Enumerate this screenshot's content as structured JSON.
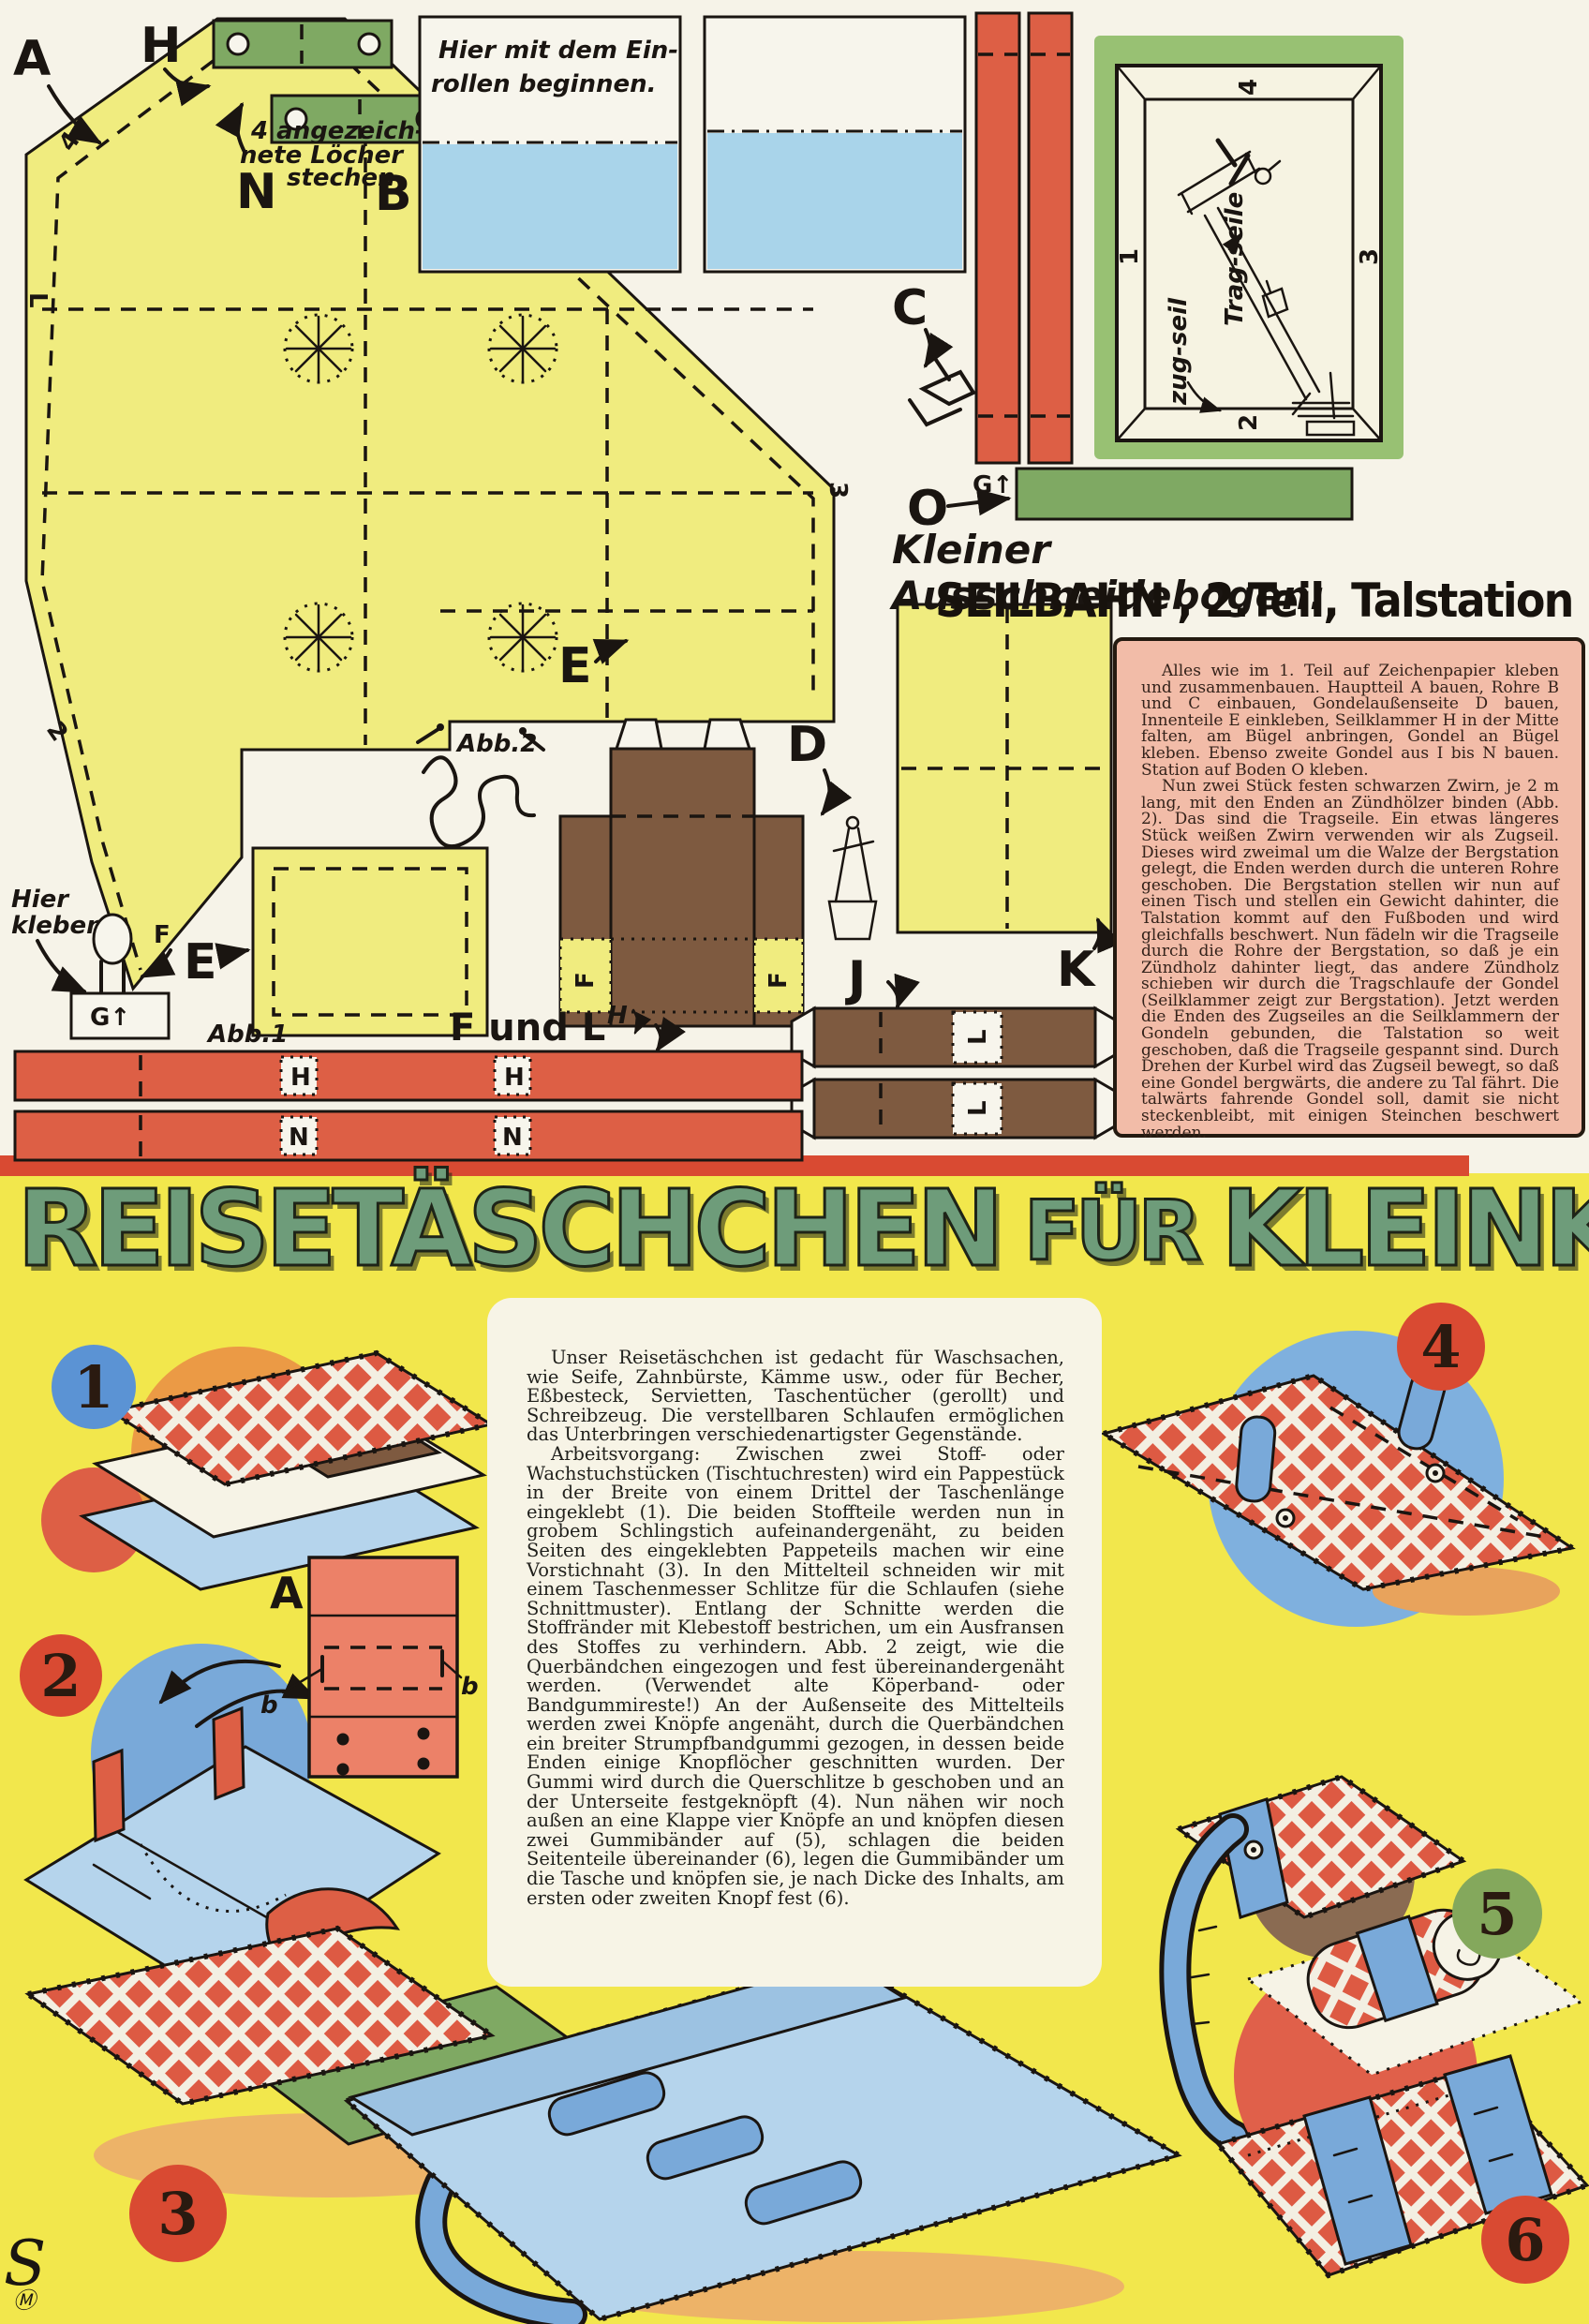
{
  "top": {
    "labels": {
      "a": "A",
      "h": "H",
      "n": "N",
      "b": "B",
      "c": "C",
      "d": "D",
      "e1": "E",
      "e2": "E",
      "j": "J",
      "k": "K",
      "o": "O",
      "g": "G↑",
      "m": "M↑",
      "f": "F",
      "fl": "F und L",
      "h_small": "H"
    },
    "tab_letters": {
      "strip1": [
        "H",
        "H"
      ],
      "strip2": [
        "N",
        "N"
      ],
      "j_tabs": [
        "L",
        "L"
      ],
      "d_tabs": [
        "F",
        "F"
      ],
      "g_box": "G↑"
    },
    "edge_marks": [
      "4",
      "L",
      "2",
      "3"
    ],
    "notes": {
      "roll_l1": "Hier mit dem Ein-",
      "roll_l2": "rollen beginnen.",
      "holes_l1": "4 angezeich-",
      "holes_l2": "nete Löcher",
      "holes_l3": "stechen",
      "kleben_l1": "Hier",
      "kleben_l2": "kleben",
      "abb1": "Abb.1",
      "abb2": "Abb.2"
    },
    "frame": {
      "n1": "1",
      "n2": "2",
      "n3": "3",
      "n4": "4",
      "label_trag": "Trag-seile",
      "label_zug": "zug-seil"
    },
    "title_script": "Kleiner Ausschneidebogen:",
    "title_main": "SEILBAHN , 2.Teil, Talstation",
    "instructions": {
      "p1": "Alles wie im 1. Teil auf Zeichenpapier kleben und zusammenbauen. Hauptteil A bauen, Rohre B und C einbauen, Gondelaußenseite D bauen, Innenteile E einkleben, Seilklammer H in der Mitte falten, am Bügel anbringen, Gondel an Bügel kleben. Ebenso zweite Gondel aus I bis N bauen. Station auf Boden O kleben.",
      "p2": "Nun zwei Stück festen schwarzen Zwirn, je 2 m lang, mit den Enden an Zündhölzer binden (Abb. 2). Das sind die Tragseile. Ein etwas längeres Stück weißen Zwirn verwenden wir als Zugseil. Dieses wird zweimal um die Walze der Bergstation gelegt, die Enden werden durch die unteren Rohre geschoben. Die Bergstation stellen wir nun auf einen Tisch und stellen ein Gewicht dahinter, die Talstation kommt auf den Fußboden und wird gleichfalls beschwert. Nun fädeln wir die Tragseile durch die Rohre der Bergstation, so daß je ein Zündholz dahinter liegt, das andere Zündholz schieben wir durch die Tragschlaufe der Gondel (Seilklammer zeigt zur Bergstation). Jetzt werden die Enden des Zugseiles an die Seilklammern der Gondeln gebunden, die Talstation so weit geschoben, daß die Tragseile gespannt sind. Durch Drehen der Kurbel wird das Zugseil bewegt, so daß eine Gondel bergwärts, die andere zu Tal fährt. Die talwärts fahrende Gondel soll, damit sie nicht steckenbleibt, mit einigen Steinchen beschwert werden."
    }
  },
  "bottom": {
    "headline": {
      "w1": "REISETÄSCHCHEN",
      "w2": "FÜR",
      "w3": "KLEINKRAM"
    },
    "body": {
      "p1": "Unser Reisetäschchen ist gedacht für Waschsachen, wie Seife, Zahnbürste, Kämme usw., oder für Becher, Eßbesteck, Servietten, Taschentücher (gerollt) und Schreibzeug. Die verstellbaren Schlaufen ermöglichen das Unterbringen verschiedenartigster Gegenstände.",
      "p2": "Arbeitsvorgang: Zwischen zwei Stoff- oder Wachstuchstücken (Tischtuchresten) wird ein Pappestück in der Breite von einem Drittel der Taschenlänge eingeklebt (1). Die beiden Stoffteile werden nun in grobem Schlingstich aufeinandergenäht, zu beiden Seiten des eingeklebten Pappeteils machen wir eine Vorstichnaht (3). In den Mittelteil schneiden wir mit einem Taschenmesser Schlitze für die Schlaufen (siehe Schnittmuster). Entlang der Schnitte werden die Stoffränder mit Klebestoff bestrichen, um ein Ausfransen des Stoffes zu verhindern. Abb. 2 zeigt, wie die Querbändchen eingezogen und fest übereinandergenäht werden. (Verwendet alte Köperband- oder Bandgummireste!) An der Außenseite des Mittelteils werden zwei Knöpfe angenäht, durch die Querbändchen ein breiter Strumpfbandgummi gezogen, in dessen beide Enden einige Knopflöcher geschnitten wurden. Der Gummi wird durch die Querschlitze b geschoben und an der Unterseite festgeknöpft (4). Nun nähen wir noch außen an eine Klappe vier Knöpfe an und knöpfen diesen zwei Gummibänder auf (5), schlagen die beiden Seitenteile übereinander (6), legen die Gummibänder um die Tasche und knöpfen sie, je nach Dicke des Inhalts, am ersten oder zweiten Knopf fest (6)."
    },
    "figures": [
      "1",
      "2",
      "3",
      "4",
      "5",
      "6"
    ],
    "schematic": {
      "a": "A",
      "b_left": "b",
      "b_right": "b"
    },
    "logo": {
      "s": "S",
      "m": "Ⓜ"
    }
  },
  "colors": {
    "paper": "#f6f3e8",
    "yellow_bg": "#f2e74c",
    "piece_yellow": "#f0ec7f",
    "piece_red": "#dd5f45",
    "piece_green": "#7fa963",
    "piece_brown": "#7e5a40",
    "pink_box": "#f2bca8",
    "headline_green": "#6e9c7a",
    "divider_red": "#d94a32",
    "blue": "#79a9d9",
    "light_blue": "#b5d4ec"
  }
}
